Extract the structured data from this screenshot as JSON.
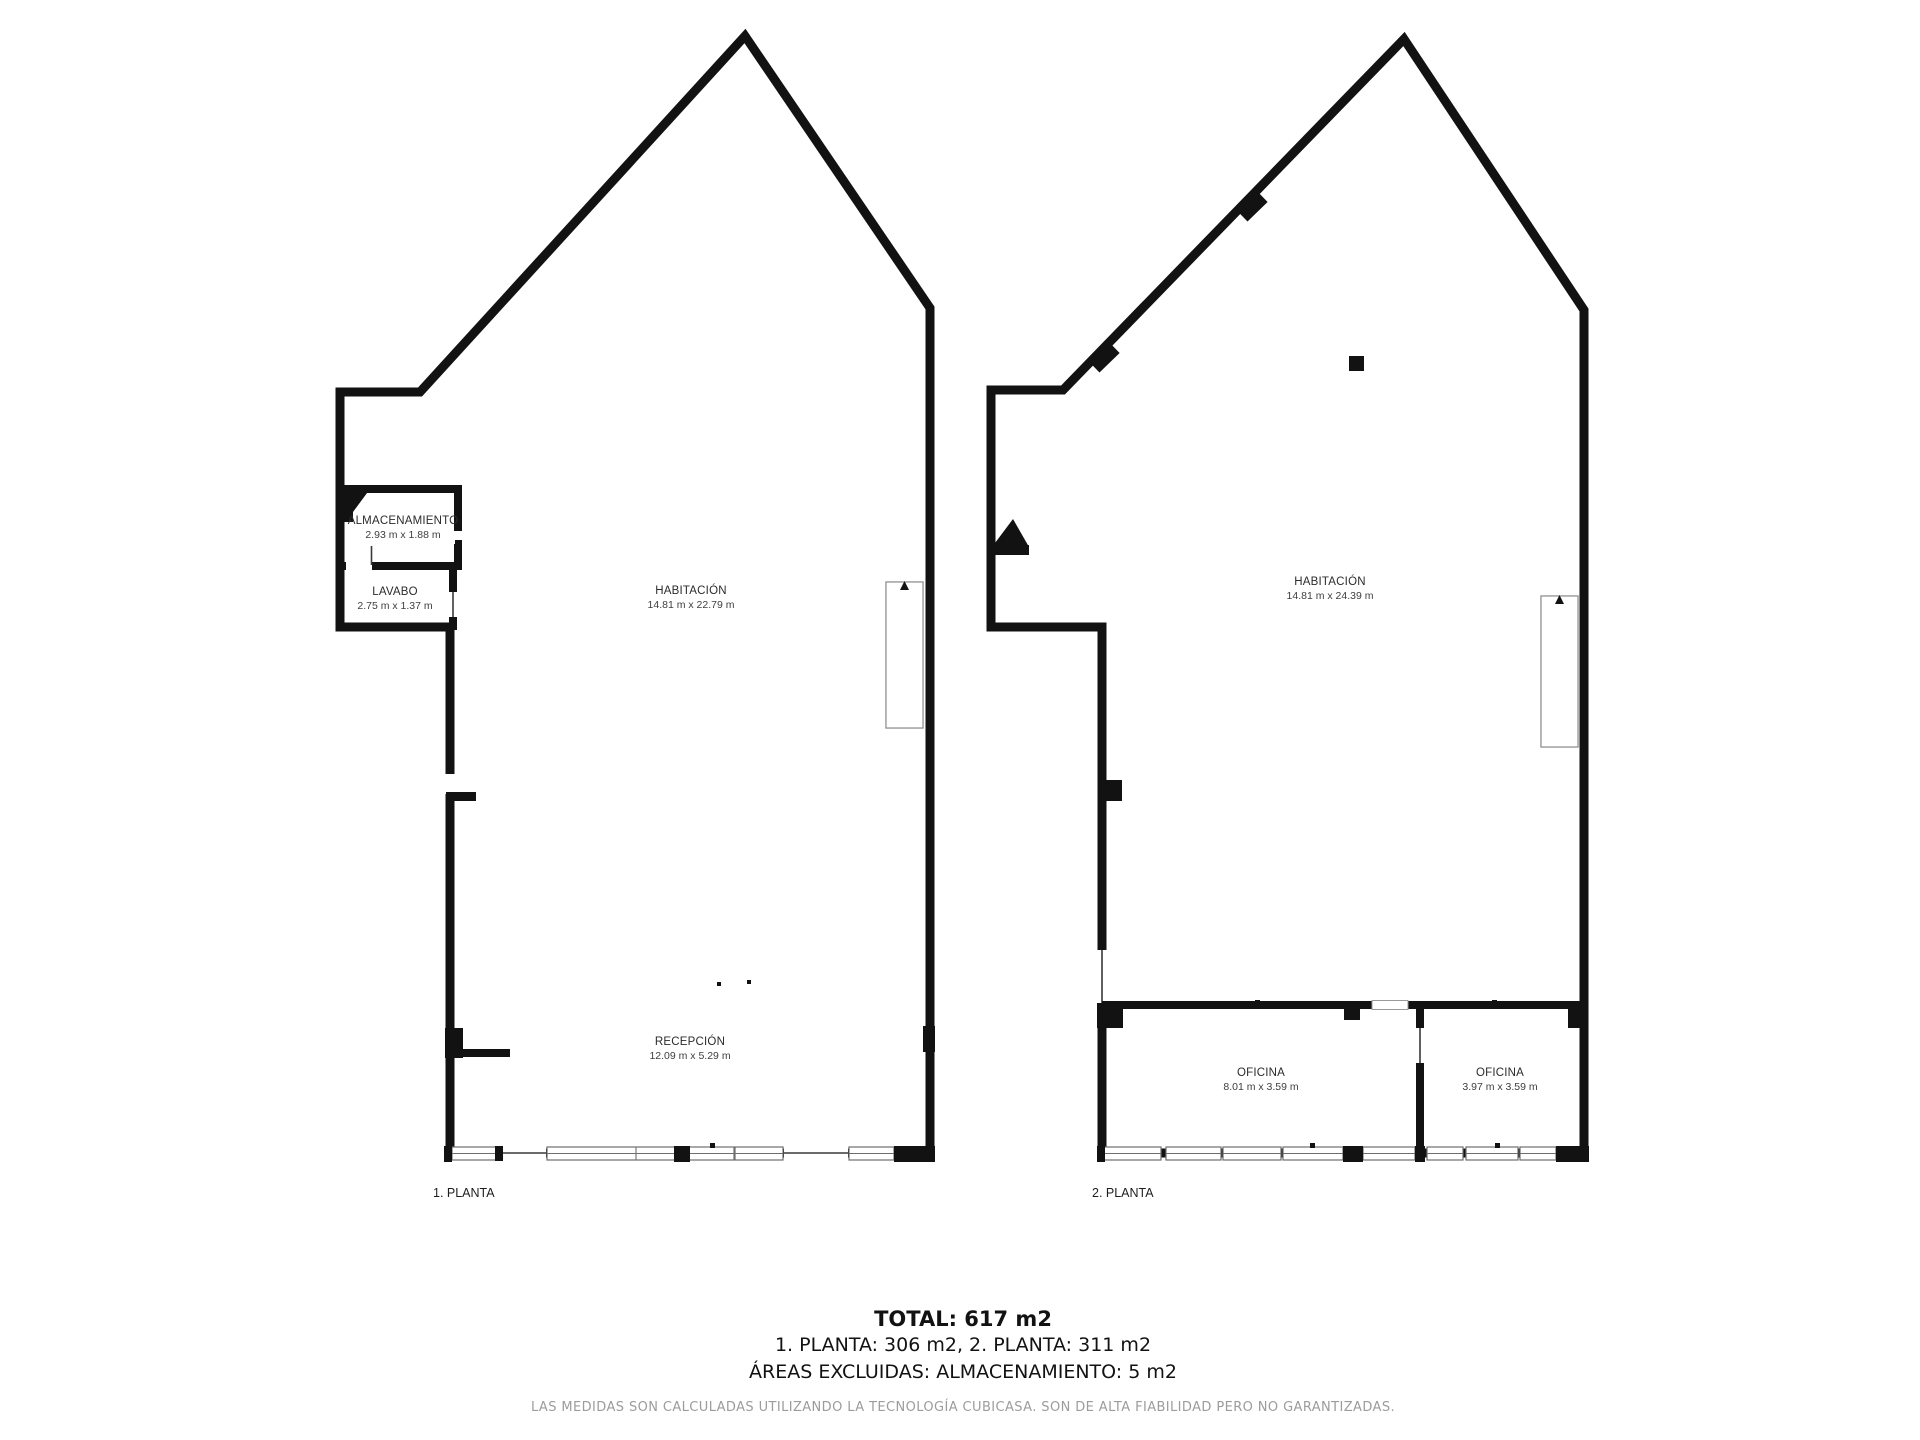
{
  "plans": [
    {
      "floor_label": "1. PLANTA",
      "rooms": [
        {
          "name": "ALMACENAMIENTO",
          "dims": "2.93 m x 1.88 m"
        },
        {
          "name": "LAVABO",
          "dims": "2.75 m x 1.37 m"
        },
        {
          "name": "HABITACIÓN",
          "dims": "14.81 m x 22.79 m"
        },
        {
          "name": "RECEPCIÓN",
          "dims": "12.09 m x 5.29 m"
        }
      ]
    },
    {
      "floor_label": "2. PLANTA",
      "rooms": [
        {
          "name": "HABITACIÓN",
          "dims": "14.81 m x 24.39 m"
        },
        {
          "name": "OFICINA",
          "dims": "8.01 m x 3.59 m"
        },
        {
          "name": "OFICINA",
          "dims": "3.97 m x 3.59 m"
        }
      ]
    }
  ],
  "summary": {
    "total": "TOTAL: 617 m2",
    "floors": "1. PLANTA: 306 m2, 2. PLANTA: 311 m2",
    "excluded": "ÁREAS EXCLUIDAS: ALMACENAMIENTO: 5 m2"
  },
  "disclaimer": "LAS MEDIDAS SON CALCULADAS UTILIZANDO LA TECNOLOGÍA CUBICASA. SON DE ALTA FIABILIDAD PERO NO GARANTIZADAS.",
  "colors": {
    "wall": "#121212",
    "window_frame": "#6e6e6e",
    "stairs": "#8f8f8f",
    "disclaimer_text": "#9c9c9c"
  }
}
